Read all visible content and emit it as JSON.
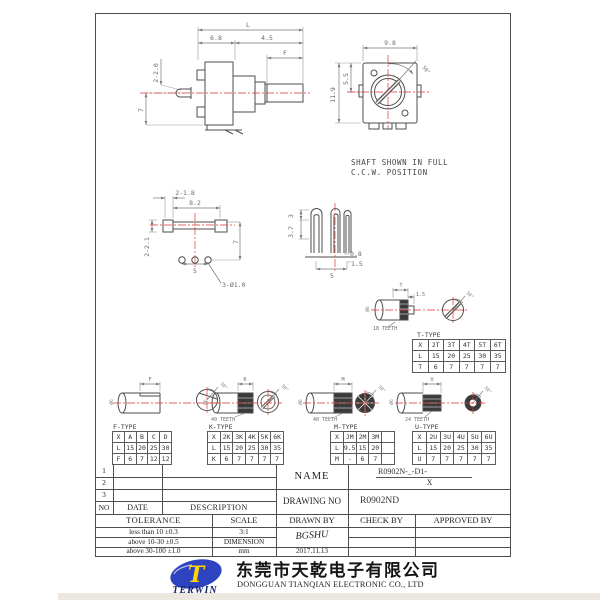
{
  "colors": {
    "linework": "#4d4d4d",
    "dimension_text": "#6b6b6b",
    "centerline_red": "#e0342e",
    "logo_blue": "#2d43c0",
    "logo_yellow": "#ffd400"
  },
  "views": {
    "side": {
      "dim_overall": "L",
      "dim_body": "6.8",
      "dim_bushing": "4.5",
      "dim_flat": "F",
      "dim_lugs": "2-2.0",
      "dim_height": "7"
    },
    "front": {
      "dim_width": "9.8",
      "dim_upper": "5.5",
      "dim_height": "11.9",
      "dim_angle": "50°",
      "note_line1": "SHAFT SHOWN IN FULL",
      "note_line2": "C.C.W. POSITION"
    },
    "bottom": {
      "dim_lugs": "2-1.8",
      "dim_span": "8.2",
      "dim_lug_h": "2-2.1",
      "dim_offset": "7",
      "dim_pitch": "5",
      "dim_holes": "3-Ø1.0"
    },
    "terminal": {
      "dim_tip": "3",
      "dim_len": "3.7",
      "dim_thick": "0.8",
      "dim_width": "1.5",
      "dim_pitch": "5"
    }
  },
  "shafts": {
    "t": {
      "dim": "T",
      "dim_tip": "1.5",
      "teeth": "18 TEETH",
      "dia": "Ø6",
      "angle": "50°"
    },
    "f": {
      "dim": "F",
      "dia": "Ø6",
      "angle": "50°"
    },
    "k": {
      "dim": "K",
      "teeth": "40 TEETH",
      "dia": "Ø6",
      "angle": "50°"
    },
    "m": {
      "dim": "M",
      "teeth": "40 TEETH",
      "dia": "Ø6",
      "angle": "50°"
    },
    "u": {
      "dim": "U",
      "teeth": "24 TEETH",
      "dia": "Ø6",
      "angle": "50°"
    }
  },
  "tables": {
    "t": {
      "title": "T-TYPE",
      "rows": [
        [
          "X",
          "2T",
          "3T",
          "4T",
          "5T",
          "6T"
        ],
        [
          "L",
          "15",
          "20",
          "25",
          "30",
          "35"
        ],
        [
          "T",
          "6",
          "7",
          "7",
          "7",
          "7"
        ]
      ]
    },
    "f": {
      "title": "F-TYPE",
      "rows": [
        [
          "X",
          "A",
          "B",
          "C",
          "D"
        ],
        [
          "L",
          "15",
          "20",
          "25",
          "30"
        ],
        [
          "F",
          "6",
          "7",
          "12",
          "12"
        ]
      ]
    },
    "k": {
      "title": "K-TYPE",
      "rows": [
        [
          "X",
          "2K",
          "3K",
          "4K",
          "5K",
          "6K"
        ],
        [
          "L",
          "15",
          "20",
          "25",
          "30",
          "35"
        ],
        [
          "K",
          "6",
          "7",
          "7",
          "7",
          "7"
        ]
      ]
    },
    "m": {
      "title": "M-TYPE",
      "rows": [
        [
          "X",
          "JM",
          "2M",
          "3M",
          ""
        ],
        [
          "L",
          "9.5",
          "15",
          "20",
          ""
        ],
        [
          "M",
          "-",
          "6",
          "7",
          ""
        ]
      ]
    },
    "u": {
      "title": "U-TYPE",
      "rows": [
        [
          "X",
          "2U",
          "3U",
          "4U",
          "5U",
          "6U"
        ],
        [
          "L",
          "15",
          "20",
          "25",
          "30",
          "35"
        ],
        [
          "U",
          "7",
          "7",
          "7",
          "7",
          "7"
        ]
      ]
    }
  },
  "title_block": {
    "rev_rows": [
      "1",
      "2",
      "3"
    ],
    "no_label": "NO",
    "date_label": "DATE",
    "description_label": "DESCRIPTION",
    "name_label": "NAME",
    "name_value_line1": "R0902N-_-D1-",
    "name_value_line2": "X",
    "drawing_no_label": "DRAWING NO",
    "drawing_no_value": "R0902ND",
    "tolerance_label": "TOLERANCE",
    "scale_label": "SCALE",
    "drawn_by_label": "DRAWN BY",
    "check_by_label": "CHECK BY",
    "approved_by_label": "APPROVED BY",
    "tolerance_row1": "less than  10  ±0.3",
    "tolerance_row2": "above 10-30 ±0.5",
    "tolerance_row3": "above 30-100 ±1.0",
    "scale_value": "3:1",
    "dimension_label": "DIMENSION",
    "unit_value": "mm",
    "drawn_signature": "BGSHU",
    "drawn_date": "2017.11.13"
  },
  "footer": {
    "logo_letter": "T",
    "logo_text": "TERWIN",
    "company_cn": "东莞市天乾电子有限公司",
    "company_en": "DONGGUAN TIANQIAN  ELECTRONIC CO., LTD"
  }
}
